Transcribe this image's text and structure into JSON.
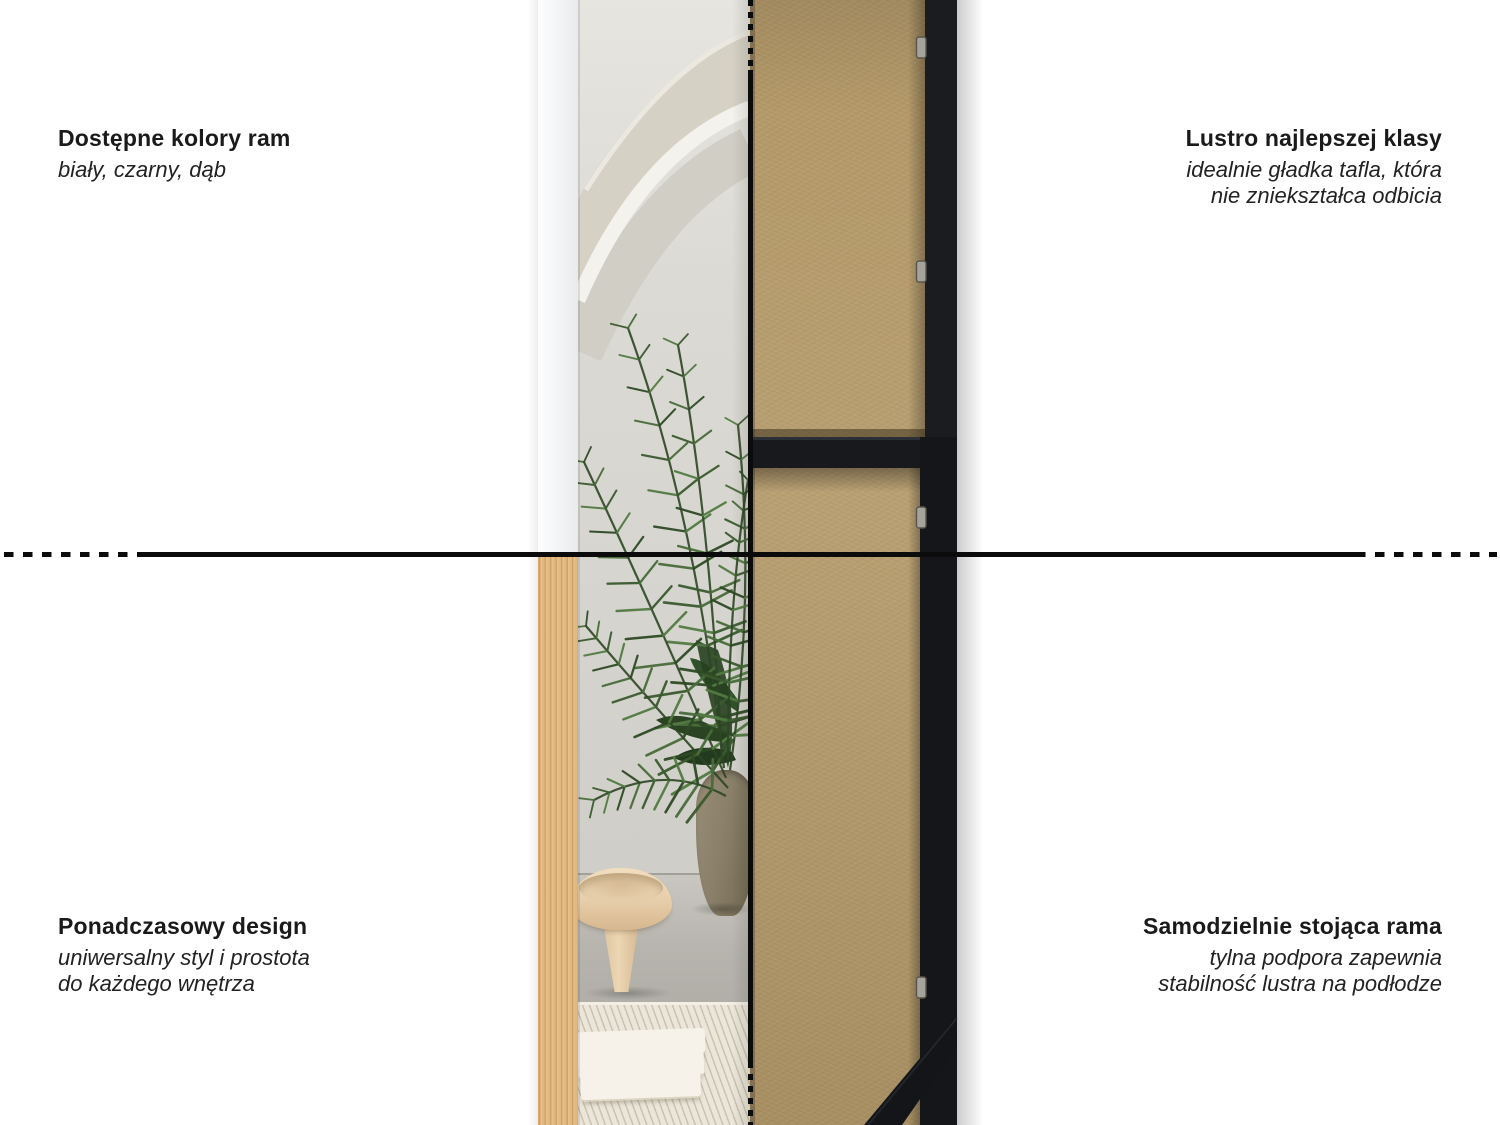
{
  "labels": {
    "top_left": {
      "title": "Dostępne kolory ram",
      "subtitle": [
        "biały, czarny, dąb"
      ]
    },
    "top_right": {
      "title": "Lustro najlepszej klasy",
      "subtitle": [
        "idealnie gładka tafla, która",
        "nie zniekształca odbicia"
      ]
    },
    "bottom_left": {
      "title": "Ponadczasowy design",
      "subtitle": [
        "uniwersalny styl i prostota",
        "do każdego wnętrza"
      ]
    },
    "bottom_right": {
      "title": "Samodzielnie stojąca rama",
      "subtitle": [
        "tylna podpora zapewnia",
        "stabilność lustra na podłodze"
      ]
    }
  },
  "photo": {
    "left_half": "mirror-front-with-room-reflection",
    "right_half": "mirror-back-mdf-panel-with-stand",
    "frame_variants_shown": [
      "white",
      "oak",
      "black"
    ]
  },
  "palette": {
    "background": "#ffffff",
    "text": "#1b1b1b",
    "divider_line": "#0b0b0b",
    "mdf_board": "#b49a6a",
    "frame_black": "#17191d",
    "frame_white": "#f4f4f3",
    "frame_oak": "#e2b87f",
    "palm_green": "#3b5a2f",
    "wall_grey": "#dcdad4",
    "floor_concrete": "#b6b4ad",
    "rug_cream": "#ebe6d9",
    "stool_wood": "#e6cda9",
    "pot_stone": "#8a8069"
  }
}
